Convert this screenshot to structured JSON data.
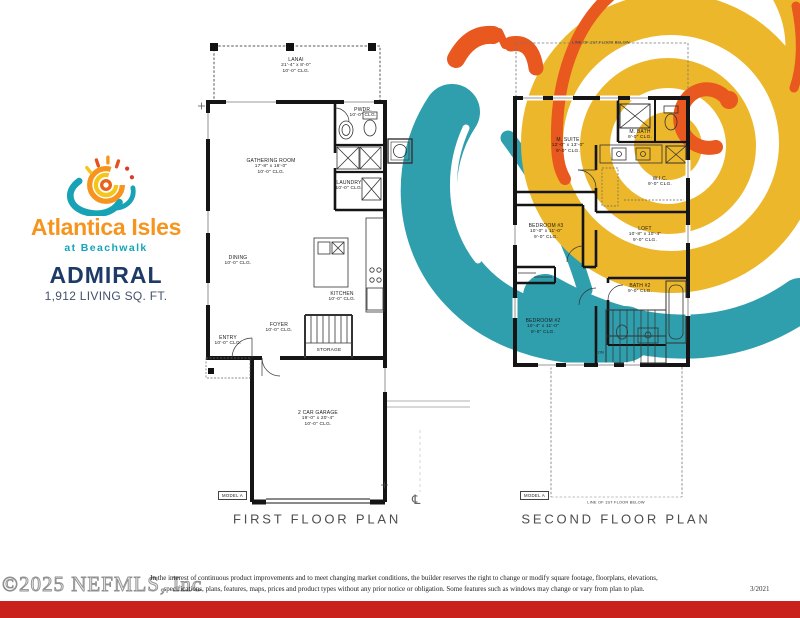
{
  "logo": {
    "brand": "Atlantica Isles",
    "tagline": "at Beachwalk",
    "plan_name": "ADMIRAL",
    "living_area": "1,912 LIVING SQ. FT."
  },
  "first_floor": {
    "caption": "FIRST FLOOR PLAN",
    "model_label": "MODEL A",
    "centerline_symbol": "℄",
    "rooms": {
      "lanai": {
        "name": "LANAI",
        "dims": "21'-4\" x 8'-0\"",
        "clg": "10'-0\" CLG."
      },
      "gathering": {
        "name": "GATHERING ROOM",
        "dims": "17'-8\" x 16'-0\"",
        "clg": "10'-0\" CLG."
      },
      "pwdr": {
        "name": "PWDR.",
        "clg": "10'-0\" CLG."
      },
      "laundry": {
        "name": "LAUNDRY",
        "clg": "10'-0\" CLG."
      },
      "dining": {
        "name": "DINING",
        "clg": "10'-0\" CLG."
      },
      "kitchen": {
        "name": "KITCHEN",
        "clg": "10'-0\" CLG."
      },
      "foyer": {
        "name": "FOYER",
        "clg": "10'-0\" CLG."
      },
      "entry": {
        "name": "ENTRY",
        "clg": "10'-0\" CLG."
      },
      "storage": {
        "name": "STORAGE"
      },
      "garage": {
        "name": "2 CAR GARAGE",
        "dims": "19'-0\" x 20'-4\"",
        "clg": "10'-0\" CLG."
      }
    }
  },
  "second_floor": {
    "caption": "SECOND FLOOR PLAN",
    "model_label": "MODEL A",
    "floor_line_note_top": "LINE OF 1ST FLOOR BELOW",
    "floor_line_note_bottom": "LINE OF 1ST FLOOR BELOW",
    "stairs_label": "DN",
    "rooms": {
      "m_suite": {
        "name": "M. SUITE",
        "dims": "12'-0\" x 13'-0\"",
        "clg": "9'-0\" CLG."
      },
      "m_bath": {
        "name": "M. BATH",
        "clg": "9'-0\" CLG."
      },
      "wic": {
        "name": "W.I.C.",
        "clg": "9'-0\" CLG."
      },
      "bedroom3": {
        "name": "BEDROOM #3",
        "dims": "10'-0\" x 11'-0\"",
        "clg": "9'-0\" CLG."
      },
      "loft": {
        "name": "LOFT",
        "dims": "10'-8\" x 10'-4\"",
        "clg": "9'-0\" CLG."
      },
      "bath2": {
        "name": "BATH #2",
        "clg": "9'-0\" CLG."
      },
      "bedroom2": {
        "name": "BEDROOM #2",
        "dims": "10'-4\" x 11'-0\"",
        "clg": "9'-0\" CLG."
      }
    }
  },
  "footer": {
    "watermark": "©2025 NEFMLS, Inc",
    "disclaimer_line1": "In the interest of continuous product improvements and to meet changing market conditions, the builder reserves the right to change or modify square footage, floorplans, elevations,",
    "disclaimer_line2": "specifications, plans, features, maps, prices and product types without any prior notice or obligation. Some features such as windows may change or vary from plan to plan.",
    "revision_date": "3/2021"
  },
  "colors": {
    "teal": "#2F9FAD",
    "yellow": "#EDB72B",
    "orange": "#E8581F",
    "red_bar": "#C9211B",
    "brand_orange": "#F7941E",
    "brand_teal": "#14A5B8",
    "navy": "#1E3A66"
  }
}
